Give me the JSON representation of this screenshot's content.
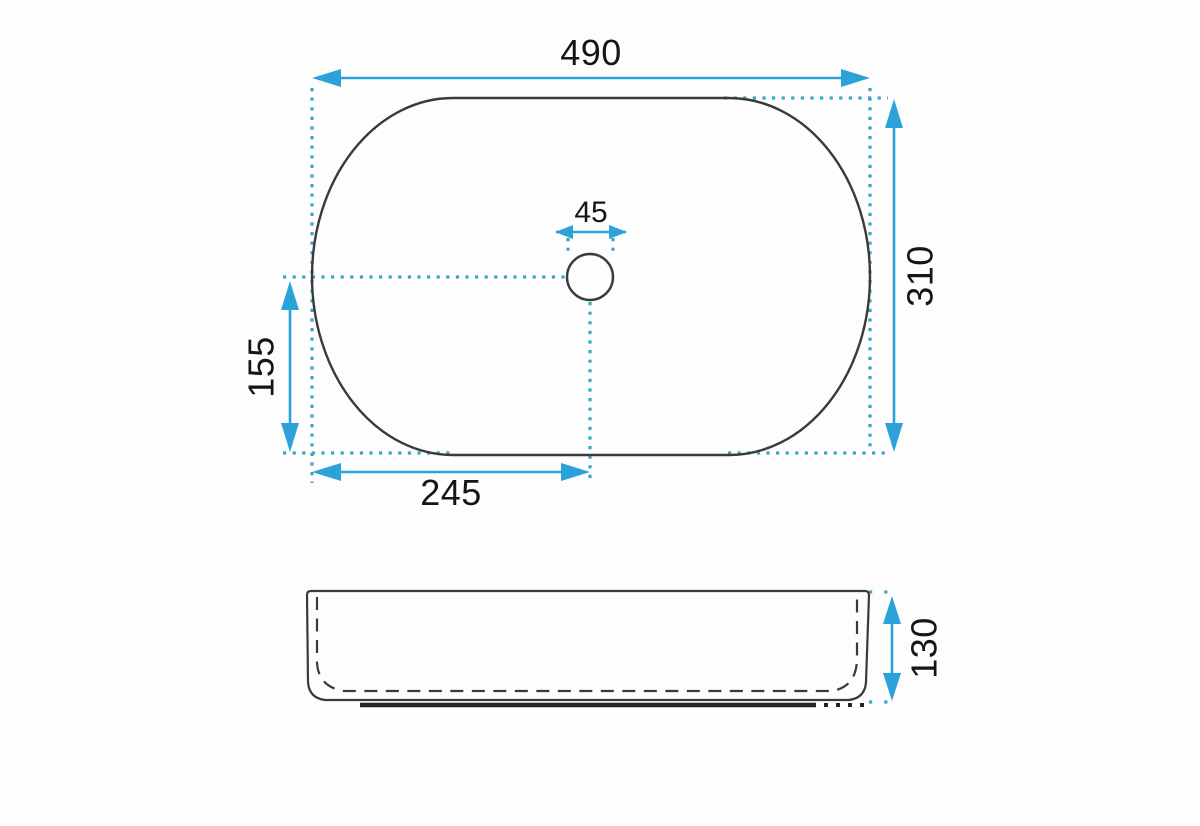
{
  "drawing": {
    "type": "technical-dimension-drawing",
    "subject": "oval countertop washbasin, top view and side view"
  },
  "colors": {
    "dimension": "#2ba3d9",
    "extension": "#38a7c6",
    "outline": "#3a3a3a",
    "base": "#242424",
    "label": "#151515",
    "background": "#fdfdfd"
  },
  "labels": {
    "width": "490",
    "height": "310",
    "drain_width": "45",
    "drain_center_from_bottom": "155",
    "drain_center_from_left": "245",
    "side_height": "130"
  }
}
